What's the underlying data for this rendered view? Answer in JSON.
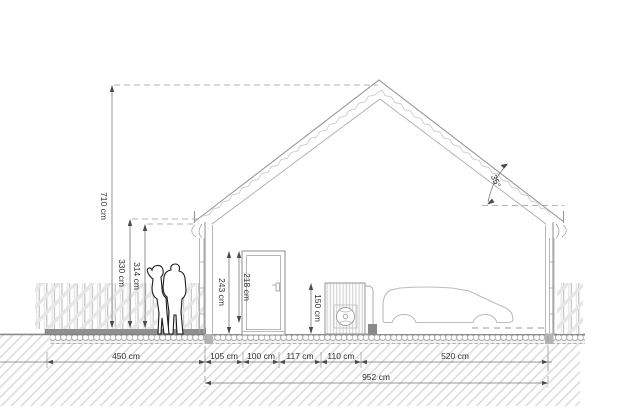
{
  "title": "House side elevation drawing",
  "dims": {
    "ridge_height": "710 cm",
    "eave_height": "330 cm",
    "eave_underside_height": "314 cm",
    "door_frame_height": "243 cm",
    "door_leaf_height": "218 cm",
    "heat_pump_height": "150 cm",
    "roof_angle": "35°",
    "terrace_width": "450 cm",
    "wall_to_door": "105 cm",
    "door_width": "100 cm",
    "door_to_heat_pump": "117 cm",
    "heat_pump_width": "110 cm",
    "right_section_width": "520 cm",
    "house_total_width": "952 cm"
  },
  "colors": {
    "structure_line": "#979797",
    "dimension_line": "#777777",
    "hatch": "#d8d8d8",
    "terrace_slab": "#8f8f8f",
    "text": "#2e2e2e"
  }
}
